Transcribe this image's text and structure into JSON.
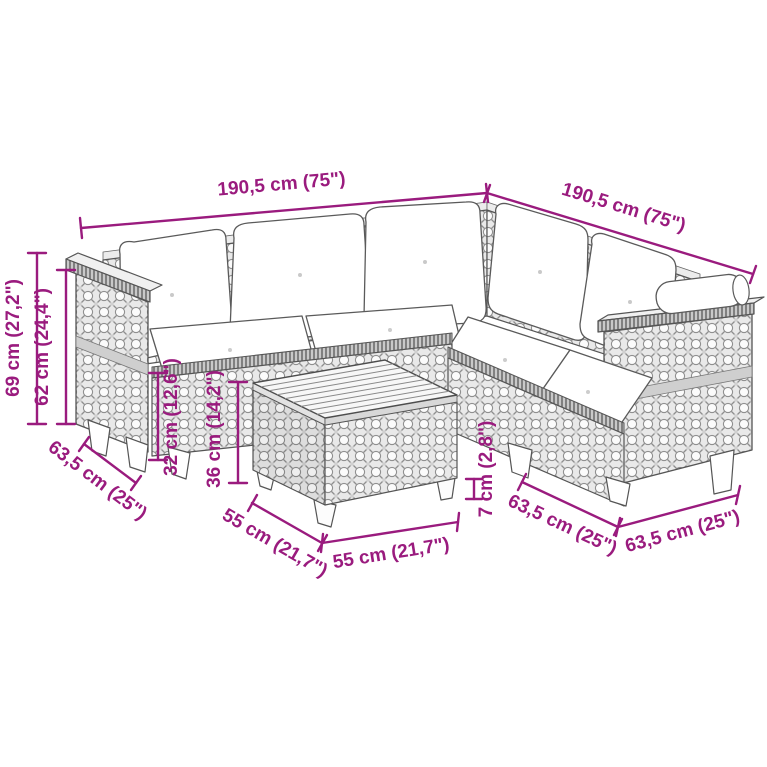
{
  "figure": {
    "description": "Line-drawing of an L-shaped poly rattan garden sofa set with cushions and a square slatted-top coffee table, annotated with product dimensions"
  },
  "colors": {
    "dimension": "#9A1B7E",
    "outline": "#555555",
    "background": "#FFFFFF"
  },
  "dimensions": {
    "left_section_width": "190,5 cm (75\")",
    "right_section_width": "190,5 cm (75\")",
    "total_height": "69 cm (27,2\")",
    "backrest_height": "62 cm (24,4\")",
    "left_arm_depth": "63,5 cm (25\")",
    "seat_height": "32 cm (12,6\")",
    "table_height": "36 cm (14,2\")",
    "table_depth": "55 cm (21,7\")",
    "table_width": "55 cm (21,7\")",
    "foot_height": "7 cm (2,8\")",
    "right_front_depth": "63,5 cm (25\")",
    "right_side_depth": "63,5 cm (25\")"
  }
}
